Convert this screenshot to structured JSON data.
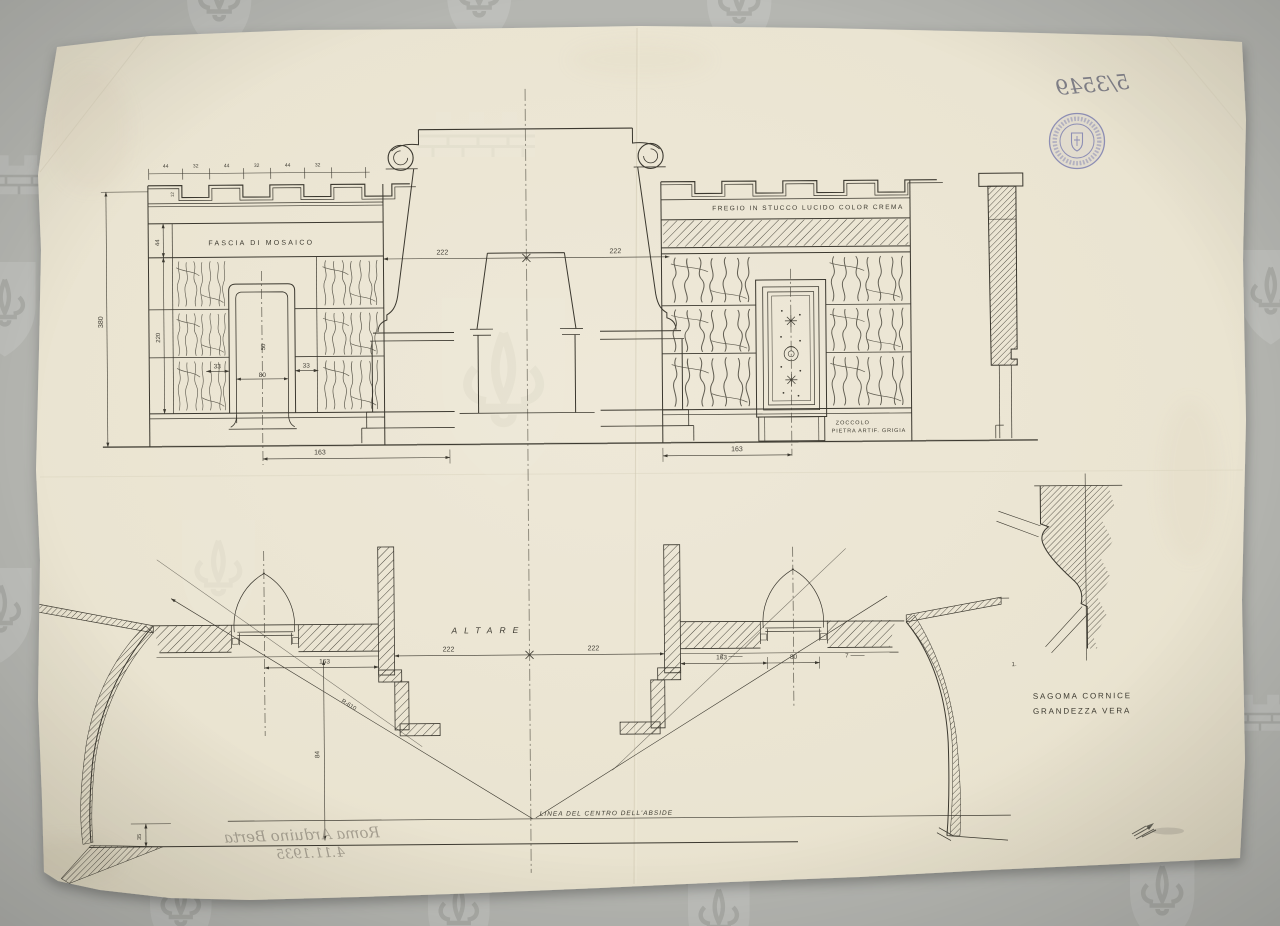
{
  "sheet": {
    "inventory_number": "5/3549",
    "signature": "Roma Arduino Berta",
    "date": "4.11.1935",
    "corner_mark": "1."
  },
  "labels": {
    "fascia": "FASCIA DI MOSAICO",
    "fregio": "FREGIO IN STUCCO LUCIDO COLOR CREMA",
    "zoccolo_1": "ZOCCOLO",
    "zoccolo_2": "PIETRA ARTIF. GRIGIA",
    "altare": "ALTARE",
    "linea_abside": "LINEA DEL CENTRO DELL'ABSIDE",
    "sagoma_1": "SAGOMA CORNICE",
    "sagoma_2": "GRANDEZZA VERA"
  },
  "dimensions": {
    "crenel_pattern": [
      "44",
      "32",
      "44",
      "32",
      "44",
      "32"
    ],
    "crenel_height": "12",
    "total_height": "380",
    "fascia_height": "44",
    "panel_height": "220",
    "span_left": "222",
    "span_right": "222",
    "plan_span_left": "222",
    "plan_span_right": "222",
    "jamb_left": "33",
    "jamb_right": "33",
    "niche_width": "80",
    "niche_inner": "50",
    "base_left": "163",
    "base_right": "163",
    "plan_offset_left": "163",
    "plan_offset_right": "163",
    "plan_niche_width": "80",
    "plan_reveal": "7",
    "apse_radius": "R-610",
    "apse_depth": "84",
    "step_height": "35"
  },
  "colors": {
    "paper": "#eae4d1",
    "background": "#b5b6b1",
    "ink": "#3b382f",
    "stamp": "#7d7fb0",
    "pencil": "#8d887c"
  }
}
